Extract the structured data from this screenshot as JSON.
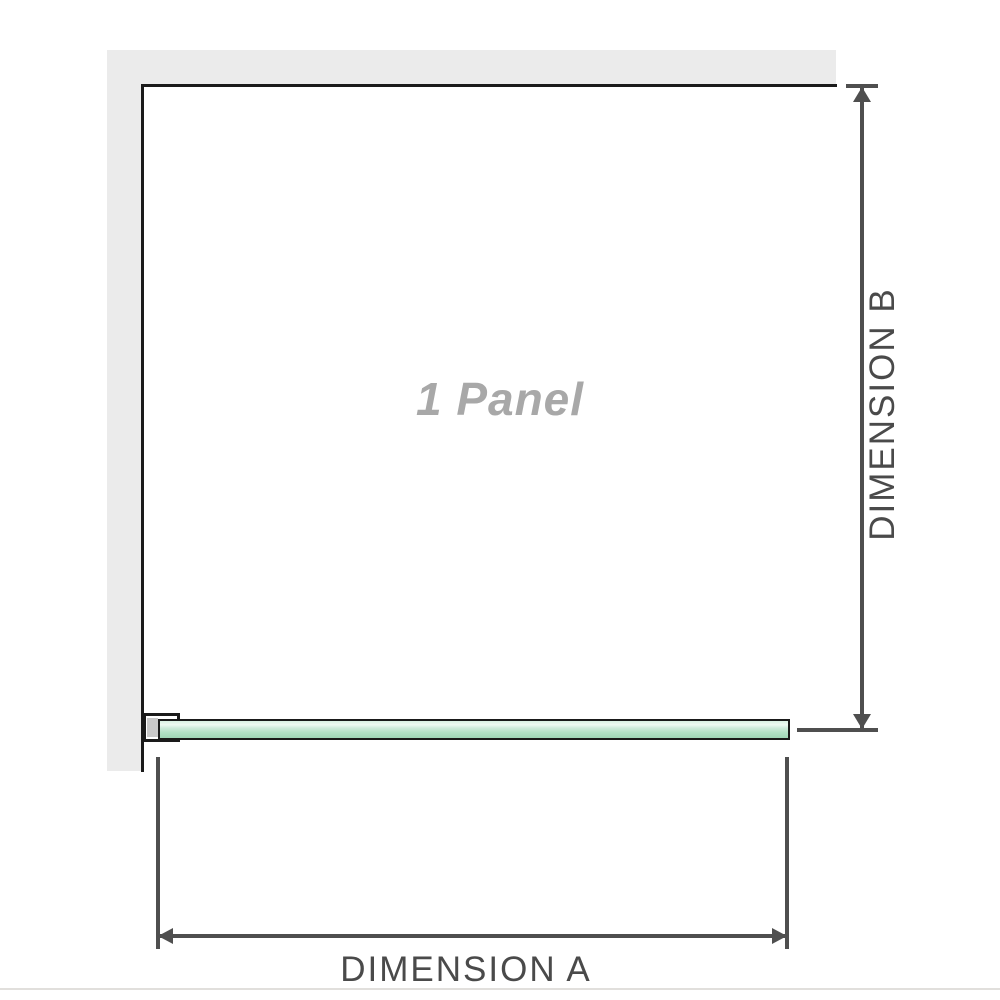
{
  "diagram": {
    "panel_label": "1 Panel",
    "dimension_a_label": "DIMENSION A",
    "dimension_b_label": "DIMENSION B"
  },
  "colors": {
    "wall_fill": "#ebebeb",
    "wall_face_line": "#1a1a1a",
    "dimension_line": "#4f4f4f",
    "dimension_text": "#4a4a4a",
    "panel_label_text": "#a8a8a8",
    "glass_outline": "#1a1a1a",
    "glass_green_highlight": "#eef9f2",
    "glass_green_mid": "#b2e1c5",
    "glass_green_dark": "#9fd6b6",
    "bracket_inner_fill": "#c8c8c8",
    "bottom_hairline": "#e1dfdc"
  }
}
